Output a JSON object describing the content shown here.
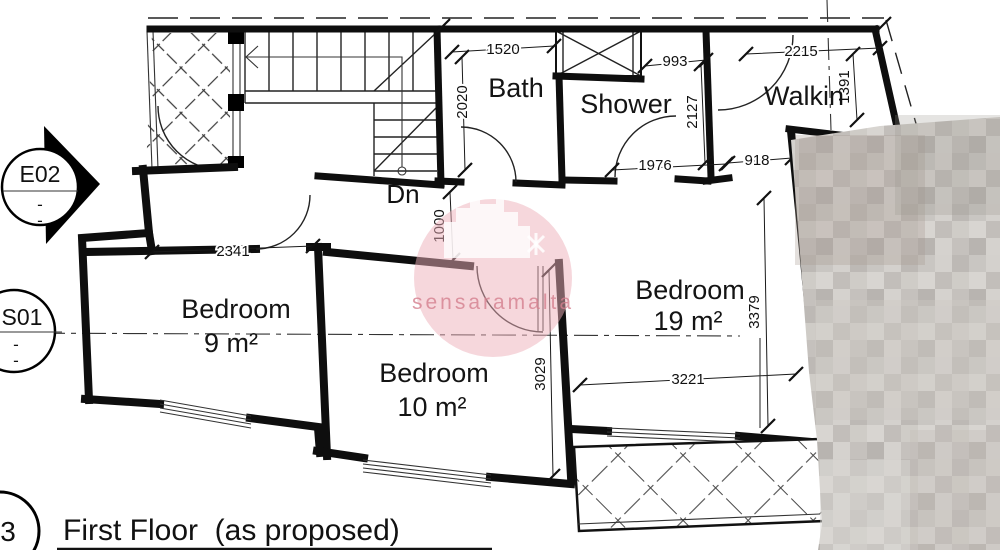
{
  "plan": {
    "rooms": {
      "bath": "Bath",
      "shower": "Shower",
      "walkin": "Walkin",
      "bedroom9": {
        "label": "Bedroom",
        "area": "9 m²"
      },
      "bedroom10": {
        "label": "Bedroom",
        "area": "10 m²"
      },
      "bedroom19": {
        "label": "Bedroom",
        "area": "19 m²"
      }
    },
    "stairs": {
      "direction_label": "Dn"
    },
    "dimensions_mm": {
      "bath_width": "1520",
      "bath_length": "2020",
      "shower_top_width": "993",
      "shower_length": "2127",
      "shower_width": "1976",
      "walkin_entry": "918",
      "walkin_width": "2215",
      "walkin_length": "1391",
      "bedroom9_width": "2341",
      "hall_passage": "1000",
      "bedroom10_length": "3029",
      "bedroom19_width": "3221",
      "bedroom19_length": "3379"
    },
    "markers": {
      "elevation": "E02",
      "section": "S01",
      "sheet_number": "3",
      "tick": "-"
    },
    "footer": {
      "title": "First Floor  (as proposed)"
    },
    "watermark": {
      "text": "sensaramalta",
      "circle_color": "#eeb0ba",
      "text_color": "#d47f8e"
    }
  }
}
